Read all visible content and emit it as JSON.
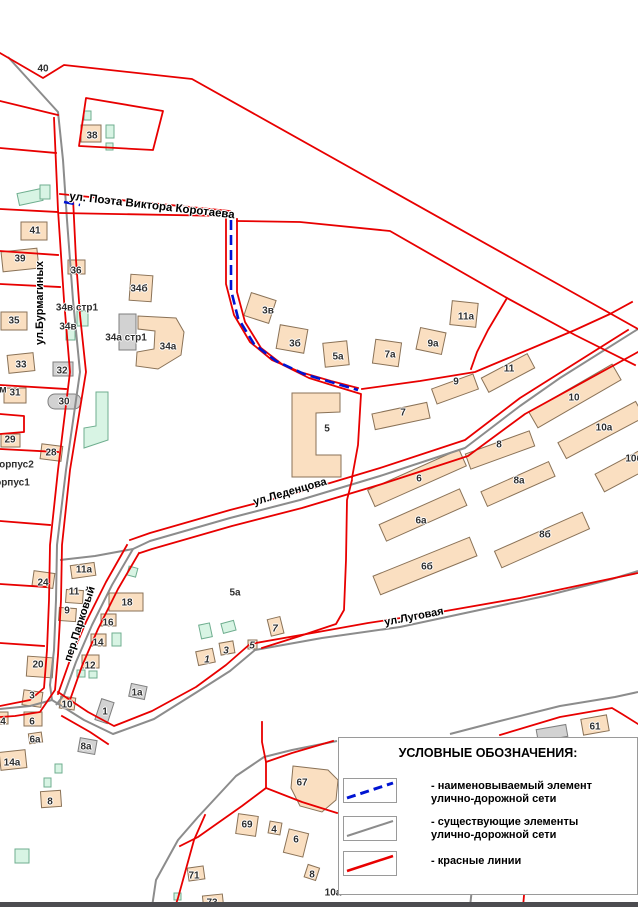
{
  "colors": {
    "red_line": "#e80000",
    "road": "#8c8c8c",
    "named_route": "#0014d2",
    "building_fill": "#fadfc1",
    "building_stroke": "#8a7257",
    "green_fill": "#d8f4e4",
    "green_stroke": "#6fae8f",
    "gray_fill": "#d2d2d2",
    "label": "#2e2e2e",
    "footer_bar": "#4c4c50"
  },
  "legend": {
    "title": "УСЛОВНЫЕ ОБОЗНАЧЕНИЯ:",
    "items": [
      {
        "id": "named-element",
        "line_style": "dashed",
        "line_color": "#0014d2",
        "label_line1": "- наименовываемый элемент",
        "label_line2": "улично-дорожной сети"
      },
      {
        "id": "existing-elements",
        "line_style": "solid",
        "line_color": "#8c8c8c",
        "label_line1": "- существующие элементы",
        "label_line2": "улично-дорожной сети"
      },
      {
        "id": "red-lines",
        "line_style": "solid",
        "line_color": "#e80000",
        "label_line1": "- красные линии",
        "label_line2": ""
      }
    ]
  },
  "map": {
    "streets": [
      {
        "id": "korotaeva",
        "name": "ул. Поэта Виктора Коротаева",
        "x": 152,
        "y": 206,
        "rot": 6.5,
        "size": 11.5
      },
      {
        "id": "burmaginykh",
        "name": "ул.Бурмагиных",
        "x": 40,
        "y": 303,
        "rot": -90,
        "size": 11
      },
      {
        "id": "ledentsova",
        "name": "ул.Леденцова",
        "x": 290,
        "y": 492,
        "rot": -16,
        "size": 11
      },
      {
        "id": "lugovaya",
        "name": "ул.Луговая",
        "x": 414,
        "y": 617,
        "rot": -11,
        "size": 11
      },
      {
        "id": "parkovyi",
        "name": "пер.Парковый",
        "x": 80,
        "y": 624,
        "rot": -72,
        "size": 11
      }
    ],
    "buildings": [
      {
        "t": "40",
        "x": 43,
        "y": 69
      },
      {
        "t": "38",
        "x": 92,
        "y": 136
      },
      {
        "t": "41",
        "x": 35,
        "y": 231
      },
      {
        "t": "39",
        "x": 20,
        "y": 259
      },
      {
        "t": "36",
        "x": 76,
        "y": 271
      },
      {
        "t": "34б",
        "x": 139,
        "y": 289
      },
      {
        "t": "34в стр1",
        "x": 77,
        "y": 308
      },
      {
        "t": "34в",
        "x": 68,
        "y": 327
      },
      {
        "t": "34а стр1",
        "x": 126,
        "y": 338
      },
      {
        "t": "34а",
        "x": 168,
        "y": 347
      },
      {
        "t": "35",
        "x": 14,
        "y": 321
      },
      {
        "t": "33",
        "x": 21,
        "y": 365
      },
      {
        "t": "м",
        "x": 3,
        "y": 390
      },
      {
        "t": "31",
        "x": 15,
        "y": 393
      },
      {
        "t": "32",
        "x": 62,
        "y": 371
      },
      {
        "t": "30",
        "x": 64,
        "y": 402
      },
      {
        "t": "29",
        "x": 10,
        "y": 440
      },
      {
        "t": "28",
        "x": 51,
        "y": 453
      },
      {
        "t": "корпус2",
        "x": 14,
        "y": 465
      },
      {
        "t": "корпус1",
        "x": 10,
        "y": 483
      },
      {
        "t": "3в",
        "x": 268,
        "y": 311
      },
      {
        "t": "3б",
        "x": 295,
        "y": 344
      },
      {
        "t": "5а",
        "x": 338,
        "y": 357
      },
      {
        "t": "7а",
        "x": 390,
        "y": 355
      },
      {
        "t": "9а",
        "x": 433,
        "y": 344
      },
      {
        "t": "11а",
        "x": 466,
        "y": 317
      },
      {
        "t": "9",
        "x": 456,
        "y": 382
      },
      {
        "t": "11",
        "x": 509,
        "y": 369
      },
      {
        "t": "7",
        "x": 403,
        "y": 413
      },
      {
        "t": "5",
        "x": 327,
        "y": 429
      },
      {
        "t": "10",
        "x": 574,
        "y": 398
      },
      {
        "t": "10а",
        "x": 604,
        "y": 428
      },
      {
        "t": "10б",
        "x": 634,
        "y": 459
      },
      {
        "t": "8",
        "x": 499,
        "y": 445
      },
      {
        "t": "8а",
        "x": 519,
        "y": 481
      },
      {
        "t": "6",
        "x": 419,
        "y": 479
      },
      {
        "t": "6а",
        "x": 421,
        "y": 521
      },
      {
        "t": "8б",
        "x": 545,
        "y": 535
      },
      {
        "t": "6б",
        "x": 427,
        "y": 567
      },
      {
        "t": "11а",
        "x": 84,
        "y": 570
      },
      {
        "t": "24",
        "x": 43,
        "y": 583
      },
      {
        "t": "11",
        "x": 74,
        "y": 592
      },
      {
        "t": "9",
        "x": 67,
        "y": 611
      },
      {
        "t": "18",
        "x": 127,
        "y": 603
      },
      {
        "t": "16",
        "x": 108,
        "y": 623
      },
      {
        "t": "14",
        "x": 98,
        "y": 643
      },
      {
        "t": "12",
        "x": 90,
        "y": 666
      },
      {
        "t": "20",
        "x": 38,
        "y": 665
      },
      {
        "t": "3",
        "x": 32,
        "y": 696
      },
      {
        "t": "10",
        "x": 67,
        "y": 705
      },
      {
        "t": "5а",
        "x": 235,
        "y": 593
      },
      {
        "t": "7",
        "x": 275,
        "y": 629,
        "it": true
      },
      {
        "t": "5",
        "x": 252,
        "y": 646,
        "it": true
      },
      {
        "t": "3",
        "x": 226,
        "y": 651,
        "it": true
      },
      {
        "t": "1",
        "x": 207,
        "y": 660,
        "it": true
      },
      {
        "t": "1а",
        "x": 137,
        "y": 693
      },
      {
        "t": "1",
        "x": 105,
        "y": 712
      },
      {
        "t": "4",
        "x": 3,
        "y": 722
      },
      {
        "t": "6",
        "x": 32,
        "y": 722
      },
      {
        "t": "6а",
        "x": 35,
        "y": 740
      },
      {
        "t": "14а",
        "x": 12,
        "y": 763
      },
      {
        "t": "8а",
        "x": 86,
        "y": 747
      },
      {
        "t": "8",
        "x": 50,
        "y": 802
      },
      {
        "t": "67",
        "x": 302,
        "y": 783
      },
      {
        "t": "69",
        "x": 247,
        "y": 825
      },
      {
        "t": "4",
        "x": 274,
        "y": 830
      },
      {
        "t": "6",
        "x": 296,
        "y": 840
      },
      {
        "t": "8",
        "x": 312,
        "y": 875
      },
      {
        "t": "71",
        "x": 194,
        "y": 876
      },
      {
        "t": "73",
        "x": 212,
        "y": 903
      },
      {
        "t": "61",
        "x": 595,
        "y": 727
      },
      {
        "t": "10а",
        "x": 333,
        "y": 893
      }
    ]
  }
}
